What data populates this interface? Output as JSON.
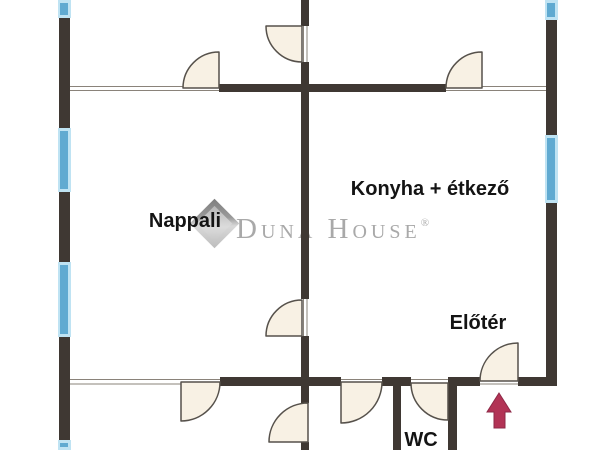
{
  "floorplan": {
    "canvas": {
      "width": 600,
      "height": 450,
      "background": "#ffffff"
    },
    "colors": {
      "wall": "#3f3833",
      "thin_line": "#8a837a",
      "door_fill": "#f8f1e4",
      "door_stroke": "#56514b",
      "window_fill": "#60aad1",
      "window_edge": "#bfe3f3",
      "arrow": "#b23355",
      "arrow_stroke": "#8e2847",
      "label": "#141414",
      "watermark": "#a9a9a9"
    },
    "labels": [
      {
        "id": "nappali",
        "text": "Nappali",
        "x": 185,
        "y": 210
      },
      {
        "id": "konyha",
        "text": "Konyha + étkező",
        "x": 430,
        "y": 178
      },
      {
        "id": "eloter",
        "text": "Előtér",
        "x": 478,
        "y": 312
      },
      {
        "id": "wc",
        "text": "WC",
        "x": 421,
        "y": 429
      }
    ],
    "watermark": {
      "brand": "Duna House",
      "registered": "®"
    },
    "thin_lines": [
      [
        70,
        86.5,
        546,
        86.5
      ],
      [
        70,
        90.5,
        546,
        90.5
      ],
      [
        70,
        379.5,
        557,
        379.5
      ],
      [
        70,
        384,
        557,
        384
      ],
      [
        303.5,
        0,
        303.5,
        450
      ],
      [
        307,
        0,
        307,
        450
      ]
    ],
    "walls": [
      [
        59,
        18,
        11,
        110
      ],
      [
        59,
        192,
        11,
        70
      ],
      [
        59,
        337,
        11,
        103
      ],
      [
        546,
        20,
        11,
        115
      ],
      [
        546,
        203,
        11,
        183
      ],
      [
        301,
        0,
        8,
        26
      ],
      [
        301,
        62,
        8,
        237
      ],
      [
        301,
        336,
        8,
        67
      ],
      [
        301,
        442,
        8,
        8
      ],
      [
        393,
        377,
        8,
        73
      ],
      [
        448,
        377,
        9,
        73
      ],
      [
        219,
        84,
        227,
        8
      ],
      [
        220,
        377,
        121,
        9
      ],
      [
        382,
        377,
        29,
        9
      ],
      [
        448,
        377,
        32,
        9
      ],
      [
        518,
        377,
        39,
        9
      ]
    ],
    "windows": [
      {
        "x": 59,
        "y": 0,
        "w": 11,
        "h": 18
      },
      {
        "x": 59,
        "y": 128,
        "w": 11,
        "h": 64
      },
      {
        "x": 59,
        "y": 262,
        "w": 11,
        "h": 75
      },
      {
        "x": 59,
        "y": 440,
        "w": 11,
        "h": 10
      },
      {
        "x": 546,
        "y": 0,
        "w": 11,
        "h": 20
      },
      {
        "x": 546,
        "y": 135,
        "w": 11,
        "h": 68
      }
    ],
    "doors": [
      {
        "hinge": [
          219,
          88
        ],
        "leaf": [
          219,
          52
        ],
        "end": [
          183,
          88
        ],
        "r": 36,
        "sweep": 0
      },
      {
        "hinge": [
          482,
          88
        ],
        "leaf": [
          482,
          52
        ],
        "end": [
          446,
          88
        ],
        "r": 36,
        "sweep": 0
      },
      {
        "hinge": [
          302,
          26
        ],
        "leaf": [
          266,
          26
        ],
        "end": [
          302,
          62
        ],
        "r": 36,
        "sweep": 0
      },
      {
        "hinge": [
          302,
          336
        ],
        "leaf": [
          266,
          336
        ],
        "end": [
          302,
          300
        ],
        "r": 36,
        "sweep": 1
      },
      {
        "hinge": [
          181,
          382
        ],
        "leaf": [
          220,
          382
        ],
        "end": [
          181,
          421
        ],
        "r": 39,
        "sweep": 1
      },
      {
        "hinge": [
          341,
          382
        ],
        "leaf": [
          382,
          382
        ],
        "end": [
          341,
          423
        ],
        "r": 41,
        "sweep": 1
      },
      {
        "hinge": [
          448,
          383
        ],
        "leaf": [
          411,
          383
        ],
        "end": [
          448,
          420
        ],
        "r": 37,
        "sweep": 0
      },
      {
        "hinge": [
          518,
          381
        ],
        "leaf": [
          518,
          343
        ],
        "end": [
          480,
          381
        ],
        "r": 38,
        "sweep": 0
      },
      {
        "hinge": [
          308,
          442
        ],
        "leaf": [
          308,
          403
        ],
        "end": [
          269,
          442
        ],
        "r": 39,
        "sweep": 0
      }
    ],
    "arrow_points": "499,393 487,412 494,412 494,428 505,428 505,412 511,412"
  }
}
